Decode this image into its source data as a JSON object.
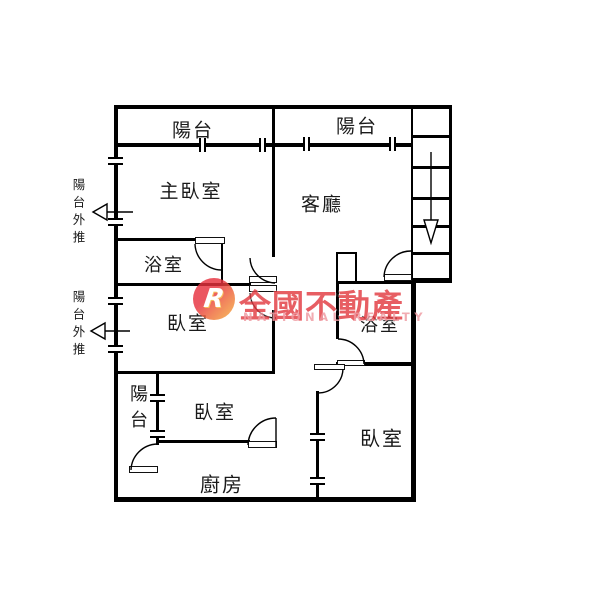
{
  "rooms": {
    "balcony_top_left": "陽台",
    "balcony_top_right": "陽台",
    "master_bedroom": "主臥室",
    "living_room": "客廳",
    "bathroom_left": "浴室",
    "bedroom_mid_left": "臥室",
    "bathroom_right": "浴室",
    "balcony_bottom": "陽台",
    "bedroom_mid_bottom": "臥室",
    "bedroom_bottom_right": "臥室",
    "kitchen": "廚房"
  },
  "annotations": {
    "balcony_pushed_out_1": "陽台外推",
    "balcony_pushed_out_2": "陽台外推"
  },
  "stairs": {
    "arrow": "down"
  },
  "watermark": {
    "brand": "全國不動產",
    "subtitle": "NATIONAL REALTY",
    "logo_letter": "R",
    "brand_color": "#e23b42",
    "subtitle_color": "#ef9aa2"
  }
}
